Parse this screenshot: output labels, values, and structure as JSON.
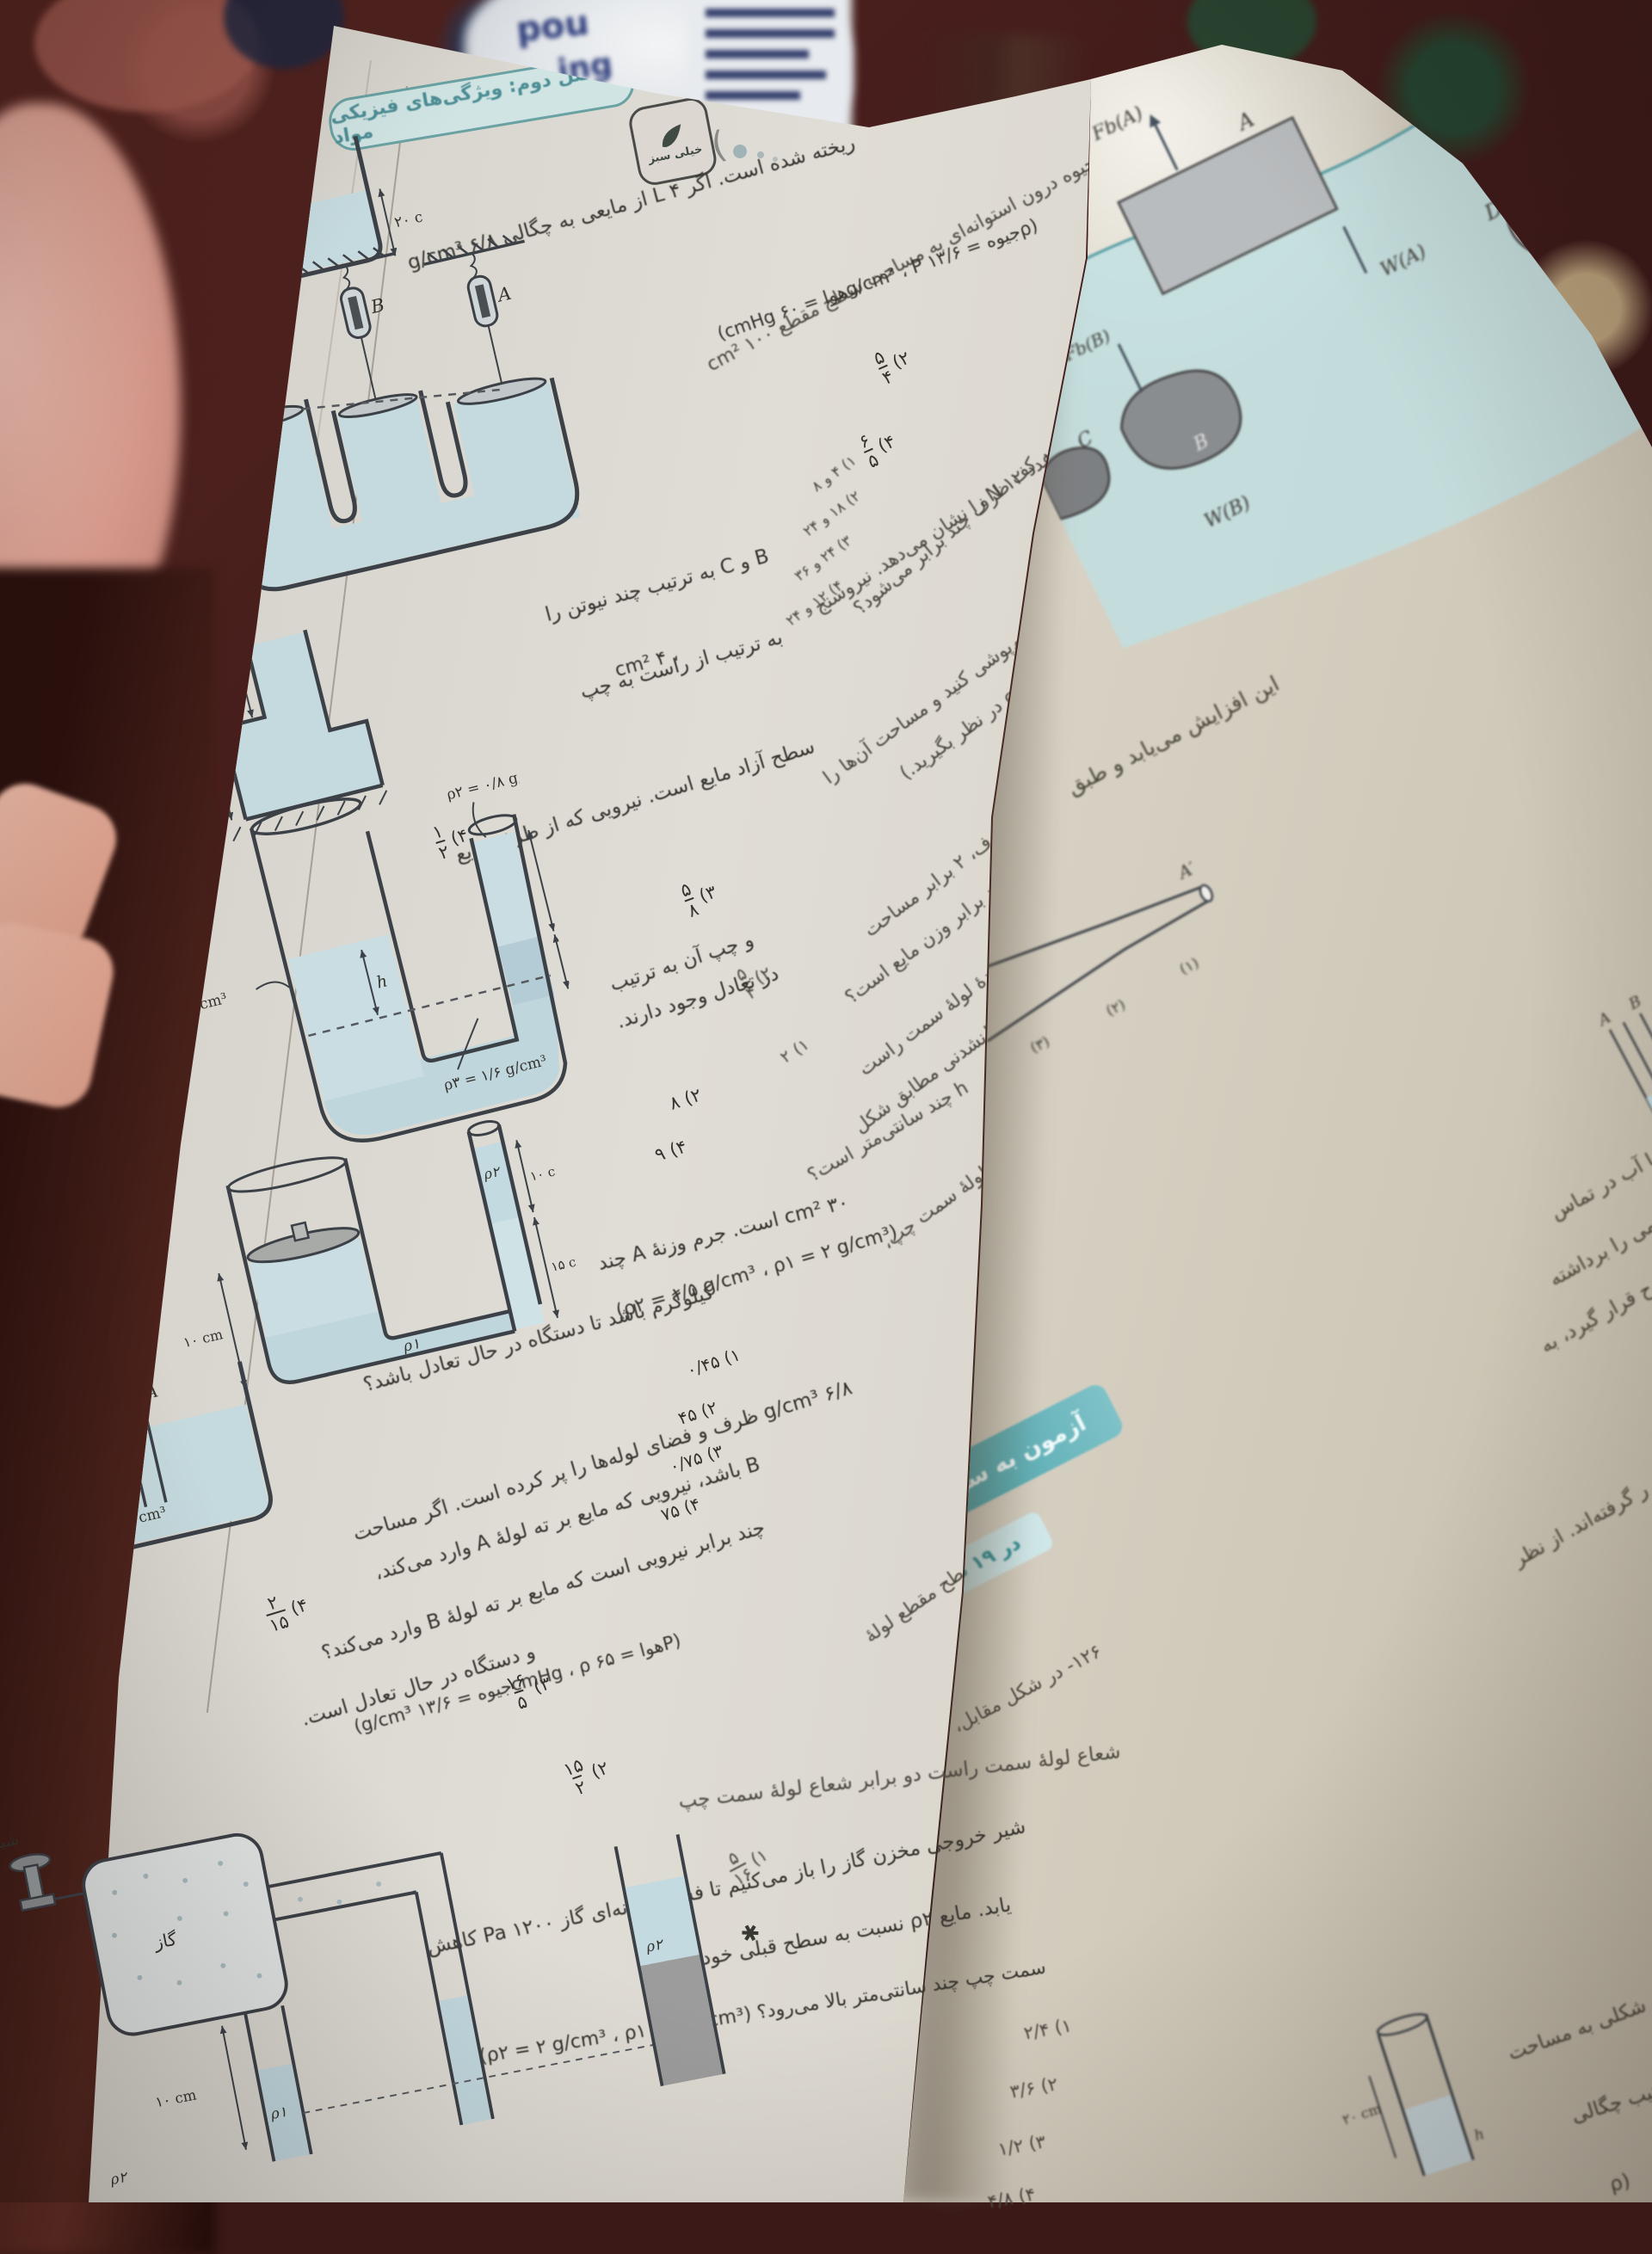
{
  "scene": {
    "carpet_color": "#3f1b1a",
    "paper_color": "#dcd8d0",
    "teal_accent": "#5e9ea0",
    "liquid_color": "#bfd6dd",
    "banner_teal": "#2f949b",
    "cushion_pink": "#dfa193"
  },
  "bag": {
    "t1": "pou",
    "t2": "ing"
  },
  "left_page": {
    "header": {
      "chapter": "فصل دوم: ویژگی‌های فیزیکی مواد",
      "logo": "خیلی سبز",
      "paren": ")"
    },
    "p120": {
      "fold1": "۱۲۰- مطابق شکل، مقداری جیوه درون استوانه‌ای به مساحت سطح مقطع ۱۰۰ cm²",
      "line1": "ریخته شده است. اگر ۴ L از مایعی به چگالی ۶/۸ g/cm³",
      "fold2": "را به ظرف اضافه کنیم، فشار وارد بر کف ظرف چند برابر می‌شود؟",
      "formula": "(ρجیوه = ۱۳/۶ g/cm³ ، Pهوا = ۶۰ cmHg)",
      "o1": {
        "label": "۱)",
        "value": "۲"
      },
      "o2": {
        "label": "۲)",
        "num": "۵",
        "den": "۴"
      },
      "o3": {
        "label": "۳)",
        "num": "۳",
        "den": "۲"
      },
      "o4": {
        "label": "۴)",
        "num": "۶",
        "den": "۵"
      }
    },
    "p121": {
      "fold1": "۱۲۱- در شکل مقابل، نیروسنج A عدد ۱۲ N را نشان می‌دهد. نیروسنج",
      "line1": "B و C به ترتیب چند نیوتن را",
      "frag_cm": "، ۴ cm²",
      "line2": "به ترتیب از راست به چپ",
      "fold2": "نشان می‌دهند؟ (از جرم پیستون‌ها چشم‌پوشی کنید و مساحت آن‌ها را",
      "fold3": "۸ cm² و ۱۲ cm² در نظر بگیرید.)",
      "opts": [
        "۱) ۴ و ۸",
        "۲) ۱۸ و ۲۴",
        "۳) ۲۴ و ۳۶",
        "۴) ۱۲ و ۲۴"
      ]
    },
    "p122": {
      "fold1": "۱۲۲- در شکل مقابل، مساحت قاعدهٔ ظرف، ۲ برابر مساحت",
      "line1": "سطح آزاد مایع است. نیرویی که از طرف مایع",
      "fold2": "به کف ظرف اعمال می‌شود، چند برابر وزن مایع است؟",
      "o1": {
        "label": "۱)",
        "value": "۲"
      },
      "o2": {
        "label": "۲)",
        "num": "۵",
        "den": "۴"
      },
      "o3": {
        "label": "۳)",
        "num": "۵",
        "den": "۸"
      },
      "o4": {
        "label": "۴)",
        "num": "۱",
        "den": "۲"
      }
    },
    "p123": {
      "fold1": "۱۲۳- در یک لولهٔ U شکل که مساحت قاعدهٔ لولهٔ سمت راست",
      "line1": "و چپ آن به ترتیب",
      "fold2": "۲ cm² و ۴ cm² است، سه مایع مخلوط‌نشدنی مطابق شکل",
      "line2": "در تعادل وجود دارند.",
      "fold3": "h چند سانتی‌متر است؟",
      "o2": "۲) ۸",
      "o4": "۴) ۹"
    },
    "p124": {
      "fold1": "۱۲۴- در شکل مقابل مساحت سطح مقطع لولهٔ سمت چپ،",
      "line1": "۳۰ cm² است. جرم وزنهٔ A چند",
      "formula": "(ρ۲ = ۱/۵ g/cm³ ، ρ۱ = ۲ g/cm³)",
      "line2": "کیلوگرم باشد تا دستگاه در حال تعادل باشد؟",
      "opts": [
        "۱) ۰/۴۵",
        "۲) ۴۵",
        "۳) ۰/۷۵",
        "۴) ۷۵"
      ]
    },
    "p125": {
      "fold1": "۱۲۵- در شکل مقابل، مایعی به چگالی",
      "line1": "۶/۸ g/cm³ ظرف و فضای لوله‌ها را پر کرده است. اگر مساحت",
      "line2": "B باشد، نیرویی که مایع بر ته لولهٔ A وارد می‌کند،",
      "fold2": "سطح مقطع لولهٔ A، دو برابر مساحت سطح مقطع لولهٔ",
      "line3": "چند برابر نیرویی است که مایع بر ته لولهٔ B وارد می‌کند؟",
      "formula": "(Pهوا = ۶۵ cmHg ، ρجیوه = ۱۳/۶ g/cm³)",
      "star": "✱",
      "o1": {
        "label": "۱)",
        "num": "۵",
        "den": "۱۶"
      },
      "o2": {
        "label": "۲)",
        "num": "۱۵",
        "den": "۲"
      },
      "o3": {
        "label": "۳)",
        "num": "۱۶",
        "den": "۵"
      },
      "o4": {
        "label": "۴)",
        "num": "۲",
        "den": "۱۵"
      }
    },
    "p126": {
      "line1": "و دستگاه در حال تعادل است.",
      "fold1": "۱۲۶- در شکل مقابل،",
      "line2": "شعاع لولهٔ سمت راست دو برابر شعاع لولهٔ سمت چپ",
      "line3": "شیر خروجی مخزن گاز را باز می‌کنیم تا فشار پیمانه‌ای گاز ۱۲۰۰ Pa کاهش",
      "line4": "یابد. مایع ρ۲ نسبت به سطح قبلی خود در لولهٔ",
      "line5": "سمت چپ چند سانتی‌متر بالا می‌رود؟ (ρ۲ = ۲ g/cm³ ، ρ۱ = ۱ g/cm³)",
      "opts": [
        "۱) ۲/۴",
        "۲) ۳/۶",
        "۳) ۱/۲",
        "۴) ۴/۸"
      ]
    },
    "diagrams": {
      "d1": {
        "h20": "۲۰ cm"
      },
      "d2": {
        "c": "C",
        "b": "B",
        "a": "A"
      },
      "d3": {
        "top": "۲h",
        "bottom": "۳h"
      },
      "d4": {
        "rho1": "ρ۱ = ۲/۴ g/cm³",
        "h": "h",
        "cm12": "۱۲ cm",
        "cm6": "۶ cm",
        "rho2": "ρ۲ = ۰/۸ g/cm³",
        "rho3": "ρ۳ = ۱/۶ g/cm³"
      },
      "d5": {
        "cm10L": "۱۰ cm",
        "cm10R": "۱۰ cm",
        "cm15": "۱۵ cm",
        "rho1": "ρ۱",
        "rho2": "ρ۲"
      },
      "d6": {
        "a": "A",
        "b": "B",
        "rho": "ρ = ۶/۸ g/cm³",
        "lenB": "۸۰ cm",
        "lenA": "۵۰ cm"
      },
      "d7": {
        "valve": "شیر خروج",
        "gas": "گاز",
        "cm10": "۱۰ cm",
        "rho1": "ρ۱",
        "rho2": "ρ۲",
        "rho2b": "ρ۲"
      }
    }
  },
  "right_page": {
    "increase_text": "این افزایش می‌یابد و طبق",
    "float_labels": {
      "fba": "Fb(A)",
      "a": "A",
      "fbb": "Fb(B)",
      "wa": "W(A)",
      "wb": "W(B)",
      "c": "C",
      "b": "B",
      "d": "D",
      "wd": "W(D)",
      "fb_cut": "Fb("
    },
    "tube": {
      "a_prime": "A′",
      "t1": "(۱)",
      "t2": "(۲)",
      "t3": "(۳)"
    },
    "banner": {
      "line1": "آزمون به سوی ۱۰۰",
      "line2": "در ۱۹ دقیقه"
    },
    "abc": {
      "a": "A",
      "b": "B",
      "c": "C"
    },
    "mini": {
      "len": "۲۰ cm",
      "h": "h"
    },
    "fragments": [
      "یا آب در تماس",
      "می را برداشته",
      "ح قرار گیرد، به",
      "ر گرفته‌اند. از نظر",
      "ی شکلی به مساحت",
      "ترتیب چگالی",
      "(ρ"
    ]
  }
}
